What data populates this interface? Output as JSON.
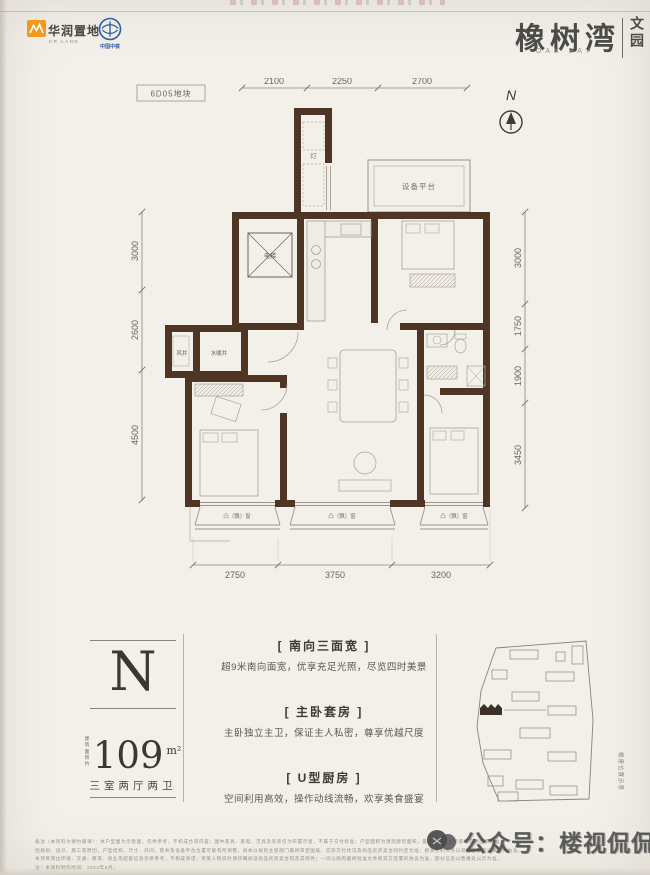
{
  "header": {
    "crland_name": "华润置地",
    "crland_sub": "CR LAND",
    "crec_name": "中国中铁",
    "project_title": "橡树湾",
    "project_title_en": "OAK BAY",
    "project_sub_vertical": "文园"
  },
  "plan": {
    "block_label": "6D05地块",
    "north_label": "N",
    "dims_top": [
      "2100",
      "2250",
      "2700"
    ],
    "dims_left": [
      "3000",
      "2600",
      "4500"
    ],
    "dims_right": [
      "3000",
      "1750",
      "1900",
      "3450"
    ],
    "dims_bottom": [
      "2750",
      "3750",
      "3200"
    ],
    "rooms": {
      "elevator": "电梯",
      "wind_shaft": "风井",
      "plumbing_shaft": "水暖井",
      "equipment_platform": "设备平台",
      "closet": "灯",
      "bay_window": "凸（飘）窗"
    }
  },
  "info": {
    "unit_letter": "N",
    "area_prefix_line1": "建筑",
    "area_prefix_line2": "面积约",
    "area_value": "109",
    "area_unit": "m²",
    "layout": "三室两厅两卫",
    "features": [
      {
        "title": "[ 南向三面宽 ]",
        "desc": "超9米南向面宽，优享充足光照，尽览四时美景"
      },
      {
        "title": "[ 主卧套房 ]",
        "desc": "主卧独立主卫，保证主人私密，尊享优越尺度"
      },
      {
        "title": "[ U型厨房 ]",
        "desc": "空间利用高效，操作动线流畅，欢享美食盛宴"
      }
    ],
    "siteplan_caption": "楼座位置示意"
  },
  "footer": {
    "disclaimer_lines": [
      "备注（本资料为要约邀请）：本户型图为示意图，仅供参考，不构成合同内容；图中家具、家电、洁具及装饰仅为布置示意，不属于交付标准；户型面积为预测建筑面积，最终以政府主管部门实测面积为准。",
      "因规划、设计、施工等原因，户型结构、尺寸、开间、管井及设备平台位置可能有所调整，具体以规划主管部门最终审定图纸、实际交付状况及商品房买卖合同约定为准；相关权利义务以双方签署的法律文件为准。",
      "本项目周边环境、交通、教育、商业等配套信息仅供参考，不构成承诺；买受人购房时请仔细阅读商品房买卖合同及其附件；一切以政府最终批准文件和双方签署的协议为准，部分信息以售楼处公示为准。",
      "注：本资料制作时间：2023年6月。"
    ],
    "watermark": "公众号：楼视侃侃"
  },
  "colors": {
    "wall": "#4e3524",
    "paper": "#f3f0ea",
    "brand_orange": "#f2991f",
    "brand_blue": "#2a5ca8"
  }
}
